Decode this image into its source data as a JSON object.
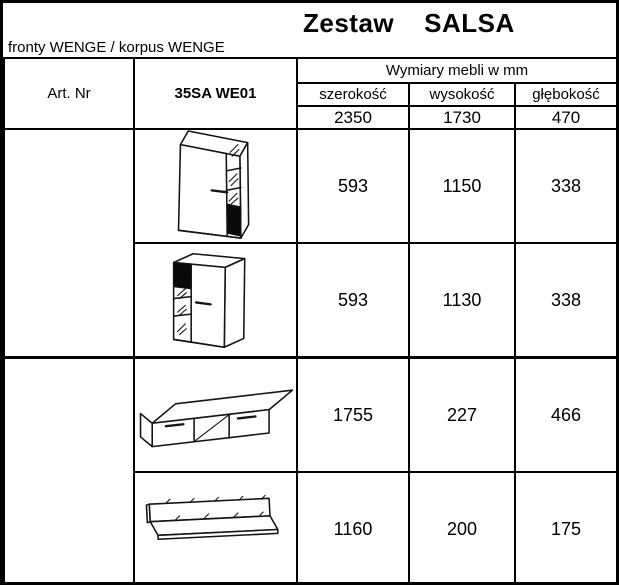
{
  "title": {
    "part1": "Zestaw",
    "part2": "SALSA"
  },
  "subtitle": "fronty WENGE / korpus WENGE",
  "table": {
    "art_nr_label": "Art. Nr",
    "set_code": "35SA WE01",
    "dims_header": "Wymiary mebli w mm",
    "col_headers": [
      "szerokość",
      "wysokość",
      "głębokość"
    ],
    "set_dims": [
      "2350",
      "1730",
      "470"
    ],
    "rows": [
      {
        "item": "cabinet with glass column right",
        "width": "593",
        "height": "1150",
        "depth": "338"
      },
      {
        "item": "cabinet with glass column left",
        "width": "593",
        "height": "1130",
        "depth": "338"
      },
      {
        "item": "tv stand with two drawers",
        "width": "1755",
        "height": "227",
        "depth": "466"
      },
      {
        "item": "wall shelf",
        "width": "1160",
        "height": "200",
        "depth": "175"
      }
    ]
  },
  "colors": {
    "line": "#000000",
    "background": "#ffffff",
    "panel_fill": "#0a0a0a"
  }
}
